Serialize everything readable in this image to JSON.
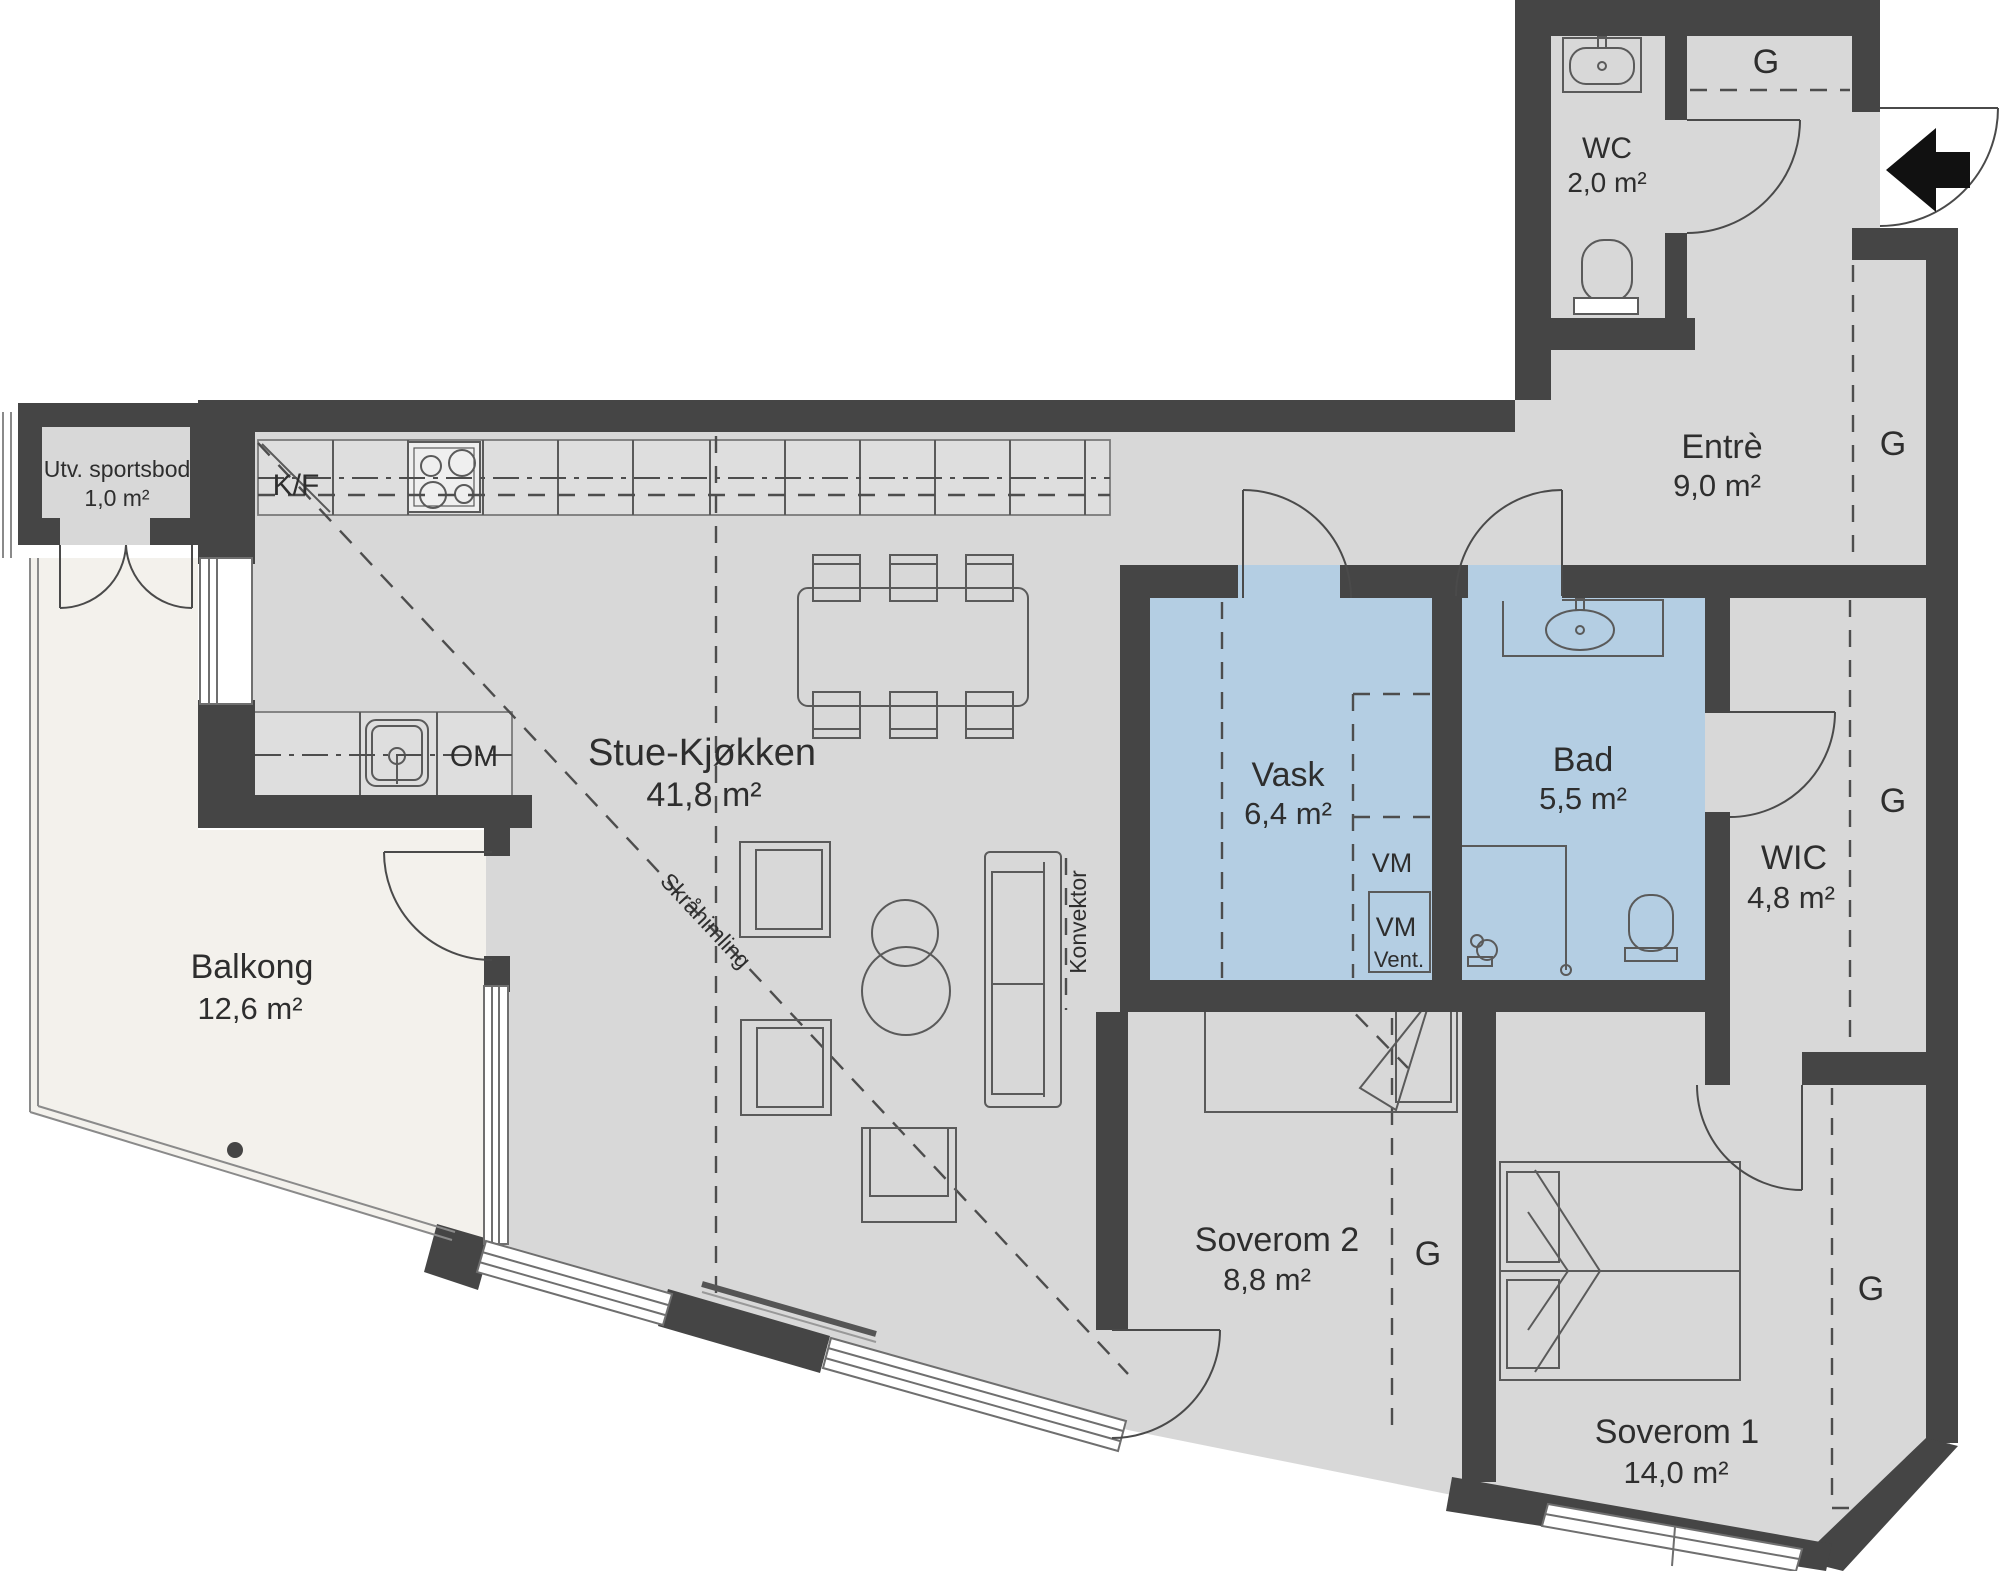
{
  "plan_title": "Apartment floor plan",
  "colors": {
    "wall": "#454545",
    "floor": "#d8d8d8",
    "wet_room": "#b4cee3",
    "outdoor": "#f3f1ec",
    "arrow": "#111111"
  },
  "rooms": [
    {
      "id": "sportsbod",
      "name": "Utv. sportsbod",
      "area": "1,0 m²"
    },
    {
      "id": "wc",
      "name": "WC",
      "area": "2,0 m²"
    },
    {
      "id": "entre",
      "name": "Entrè",
      "area": "9,0 m²"
    },
    {
      "id": "stue-kjokken",
      "name": "Stue-Kjøkken",
      "area": "41,8 m²"
    },
    {
      "id": "vask",
      "name": "Vask",
      "area": "6,4 m²"
    },
    {
      "id": "bad",
      "name": "Bad",
      "area": "5,5 m²"
    },
    {
      "id": "wic",
      "name": "WIC",
      "area": "4,8 m²"
    },
    {
      "id": "balkong",
      "name": "Balkong",
      "area": "12,6 m²"
    },
    {
      "id": "soverom2",
      "name": "Soverom 2",
      "area": "8,8 m²"
    },
    {
      "id": "soverom1",
      "name": "Soverom 1",
      "area": "14,0 m²"
    }
  ],
  "labels": {
    "g": "G",
    "kf": "K/F",
    "om": "OM",
    "vm": "VM",
    "vent": "Vent.",
    "konvektor": "Konvektor",
    "skrahimling": "Skråhimling"
  }
}
